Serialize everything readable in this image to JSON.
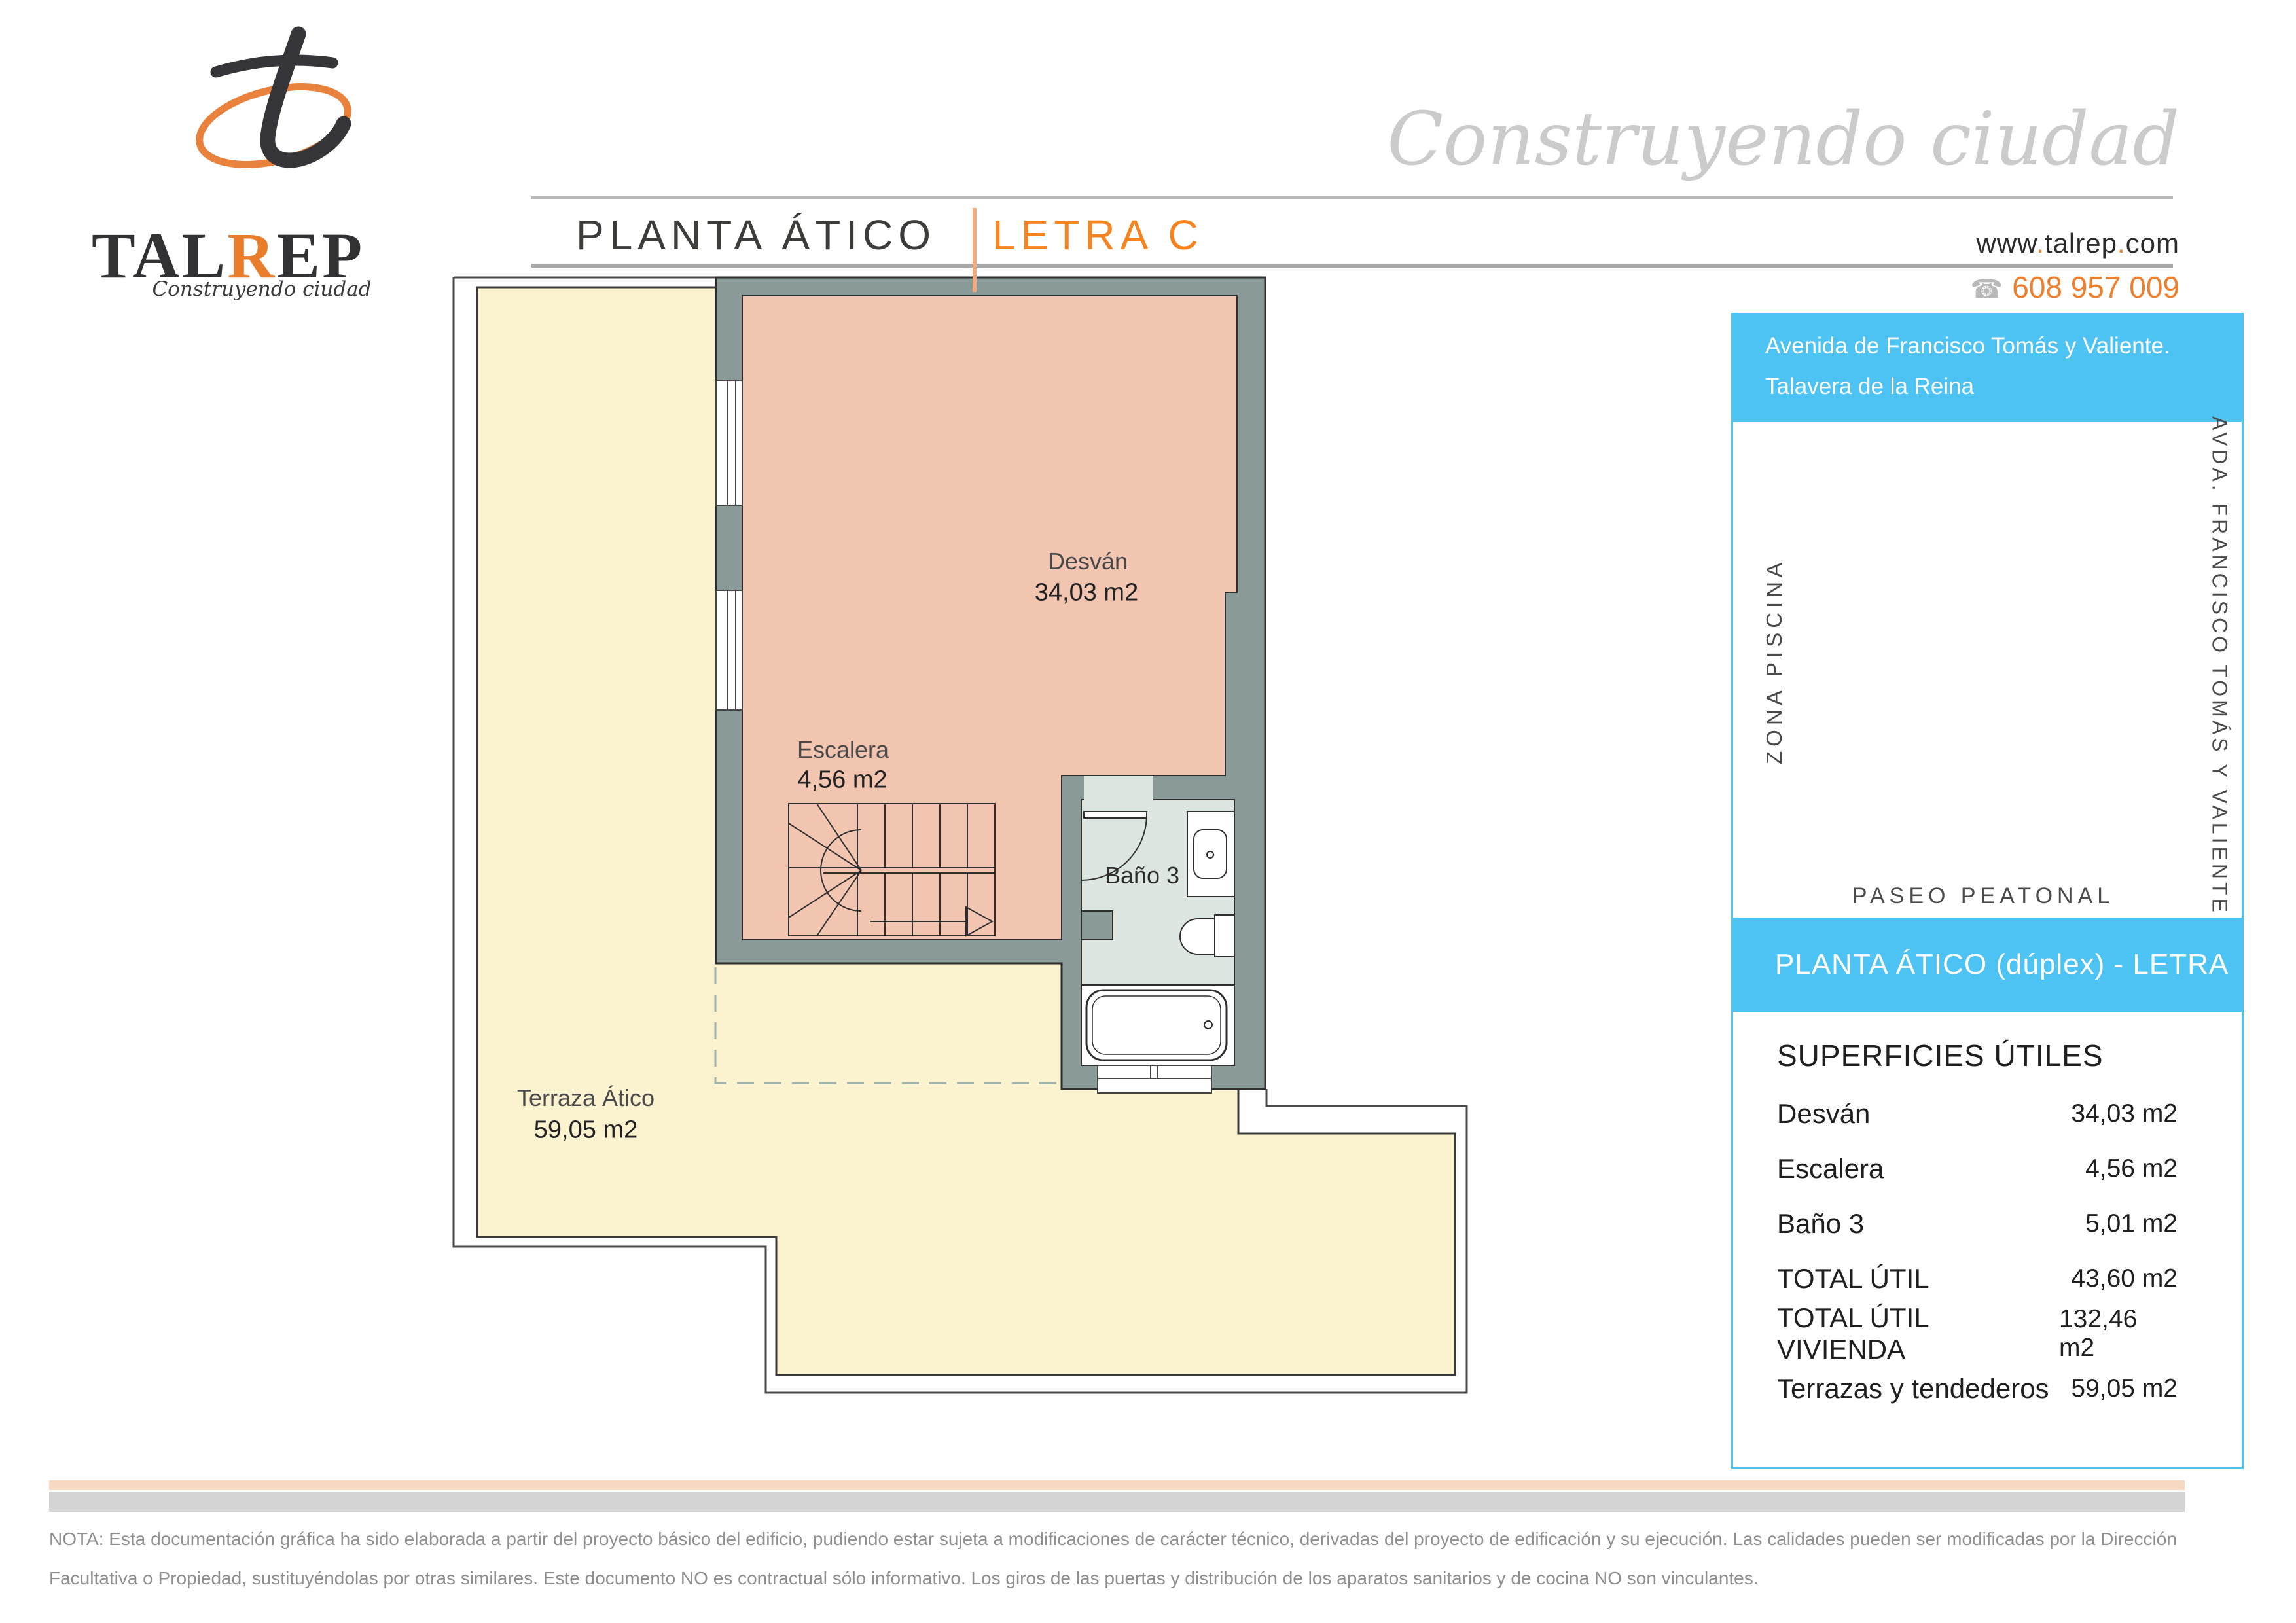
{
  "brand": {
    "name_prefix": "TAL",
    "name_accent": "R",
    "name_suffix": "EP",
    "tagline": "Construyendo ciudad"
  },
  "header": {
    "title": "PLANTA ÁTICO",
    "separator": "|",
    "subtitle": "LETRA C",
    "watermark": "Construyendo ciudad",
    "website_parts": [
      "www",
      ".",
      "talrep",
      ".",
      "com"
    ],
    "phone_icon": "☎",
    "phone": "608 957 009"
  },
  "address": {
    "line1": "Avenida de Francisco Tomás y Valiente.",
    "line2": "Talavera de la Reina"
  },
  "site_plan": {
    "label_left": "ZONA PISCINA",
    "label_right": "AVDA. FRANCISCO TOMÁS Y VALIENTE",
    "label_bottom": "PASEO PEATONAL",
    "compass": "N"
  },
  "unit_bar": {
    "text": "PLANTA  ÁTICO (dúplex)  -  LETRA",
    "letter": "C"
  },
  "surfaces": {
    "title": "SUPERFICIES ÚTILES",
    "rows": [
      {
        "label": "Desván",
        "value": "34,03 m2"
      },
      {
        "label": "Escalera",
        "value": "4,56 m2"
      },
      {
        "label": "Baño 3",
        "value": "5,01 m2"
      },
      {
        "label": "TOTAL   ÚTIL",
        "value": "43,60 m2"
      },
      {
        "label": "TOTAL   ÚTIL VIVIENDA",
        "value": "132,46 m2"
      },
      {
        "label": "Terrazas y tendederos",
        "value": "59,05 m2"
      }
    ]
  },
  "plan": {
    "desvan": {
      "name": "Desván",
      "area": "34,03 m2"
    },
    "escalera": {
      "name": "Escalera",
      "area": "4,56 m2"
    },
    "bano": {
      "name": "Baño 3"
    },
    "terraza": {
      "name": "Terraza Ático",
      "area": "59,05 m2"
    }
  },
  "note": {
    "line1": "NOTA: Esta documentación gráfica ha sido elaborada a partir del proyecto básico del edificio, pudiendo estar sujeta a modificaciones de carácter técnico, derivadas del proyecto de edificación y su ejecución. Las calidades pueden ser modificadas por la Dirección",
    "line2": "Facultativa o Propiedad, sustituyéndolas por otras similares. Este documento NO es contractual sólo informativo. Los giros de las puertas y distribución de los aparatos sanitarios y de cocina NO son vinculantes."
  },
  "colors": {
    "accent_orange": "#f5831f",
    "phone_orange": "#ee7f2d",
    "sky_blue": "#4dc3f4",
    "wall_gray": "#8a9a98",
    "room_salmon": "#f2c5b1",
    "bath_green": "#dce5e0",
    "terrace_yellow": "#fbf2d0",
    "highlight_yellow": "#f6c549",
    "bar_peach": "#f6d9c0",
    "bar_gray": "#d4d4d4"
  }
}
